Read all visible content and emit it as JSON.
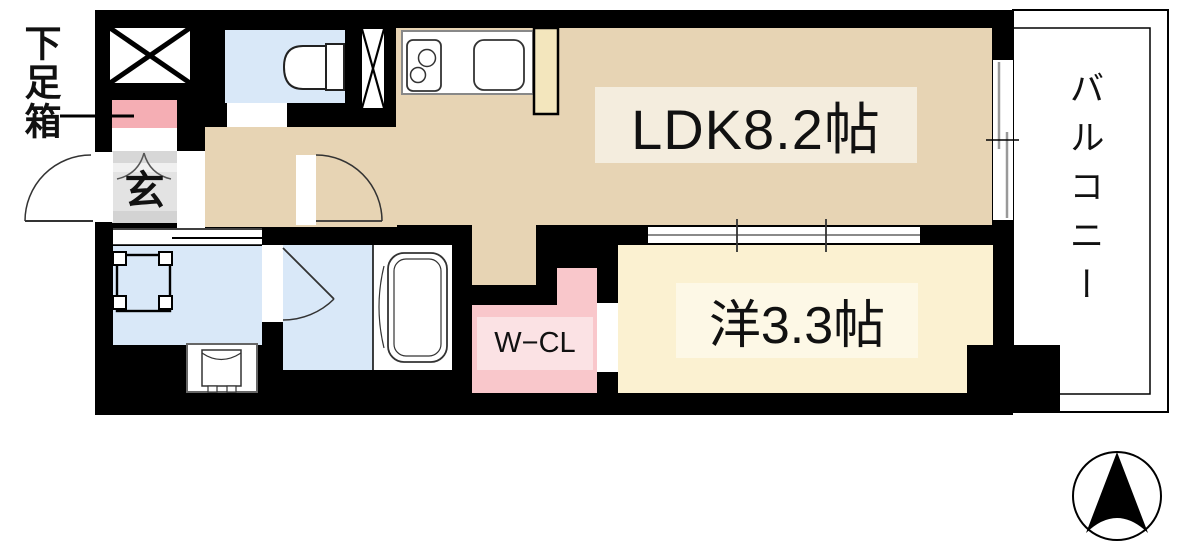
{
  "floor_plan": {
    "unit_labels": {
      "ldk": "LDK8.2帖",
      "western_room": "洋3.3帖",
      "walk_in_closet": "W−CL",
      "entrance": "玄",
      "balcony": "バルコニー",
      "shoe_box": "下足箱"
    },
    "colors": {
      "wall": "#000000",
      "ldk_floor": "#e7d4b4",
      "ldk_label_bg": "#f4edde",
      "western_floor": "#fbf1d1",
      "western_label_bg": "#fdf8e6",
      "wet_floor": "#d9e8f8",
      "closet_floor": "#f9c7cb",
      "closet_label_bg": "#fbe2e4",
      "shoe_box_fill": "#f5aeb4",
      "entrance_floor": "#e3e3e3",
      "cabinet_fill": "#f3e6bd",
      "fixture_white": "#ffffff"
    },
    "icons": {
      "north_arrow": "north-compass-arrow",
      "shaft_x": "crossed-box-shaft",
      "pipe_space_x": "crossed-box-pipe-space"
    }
  }
}
